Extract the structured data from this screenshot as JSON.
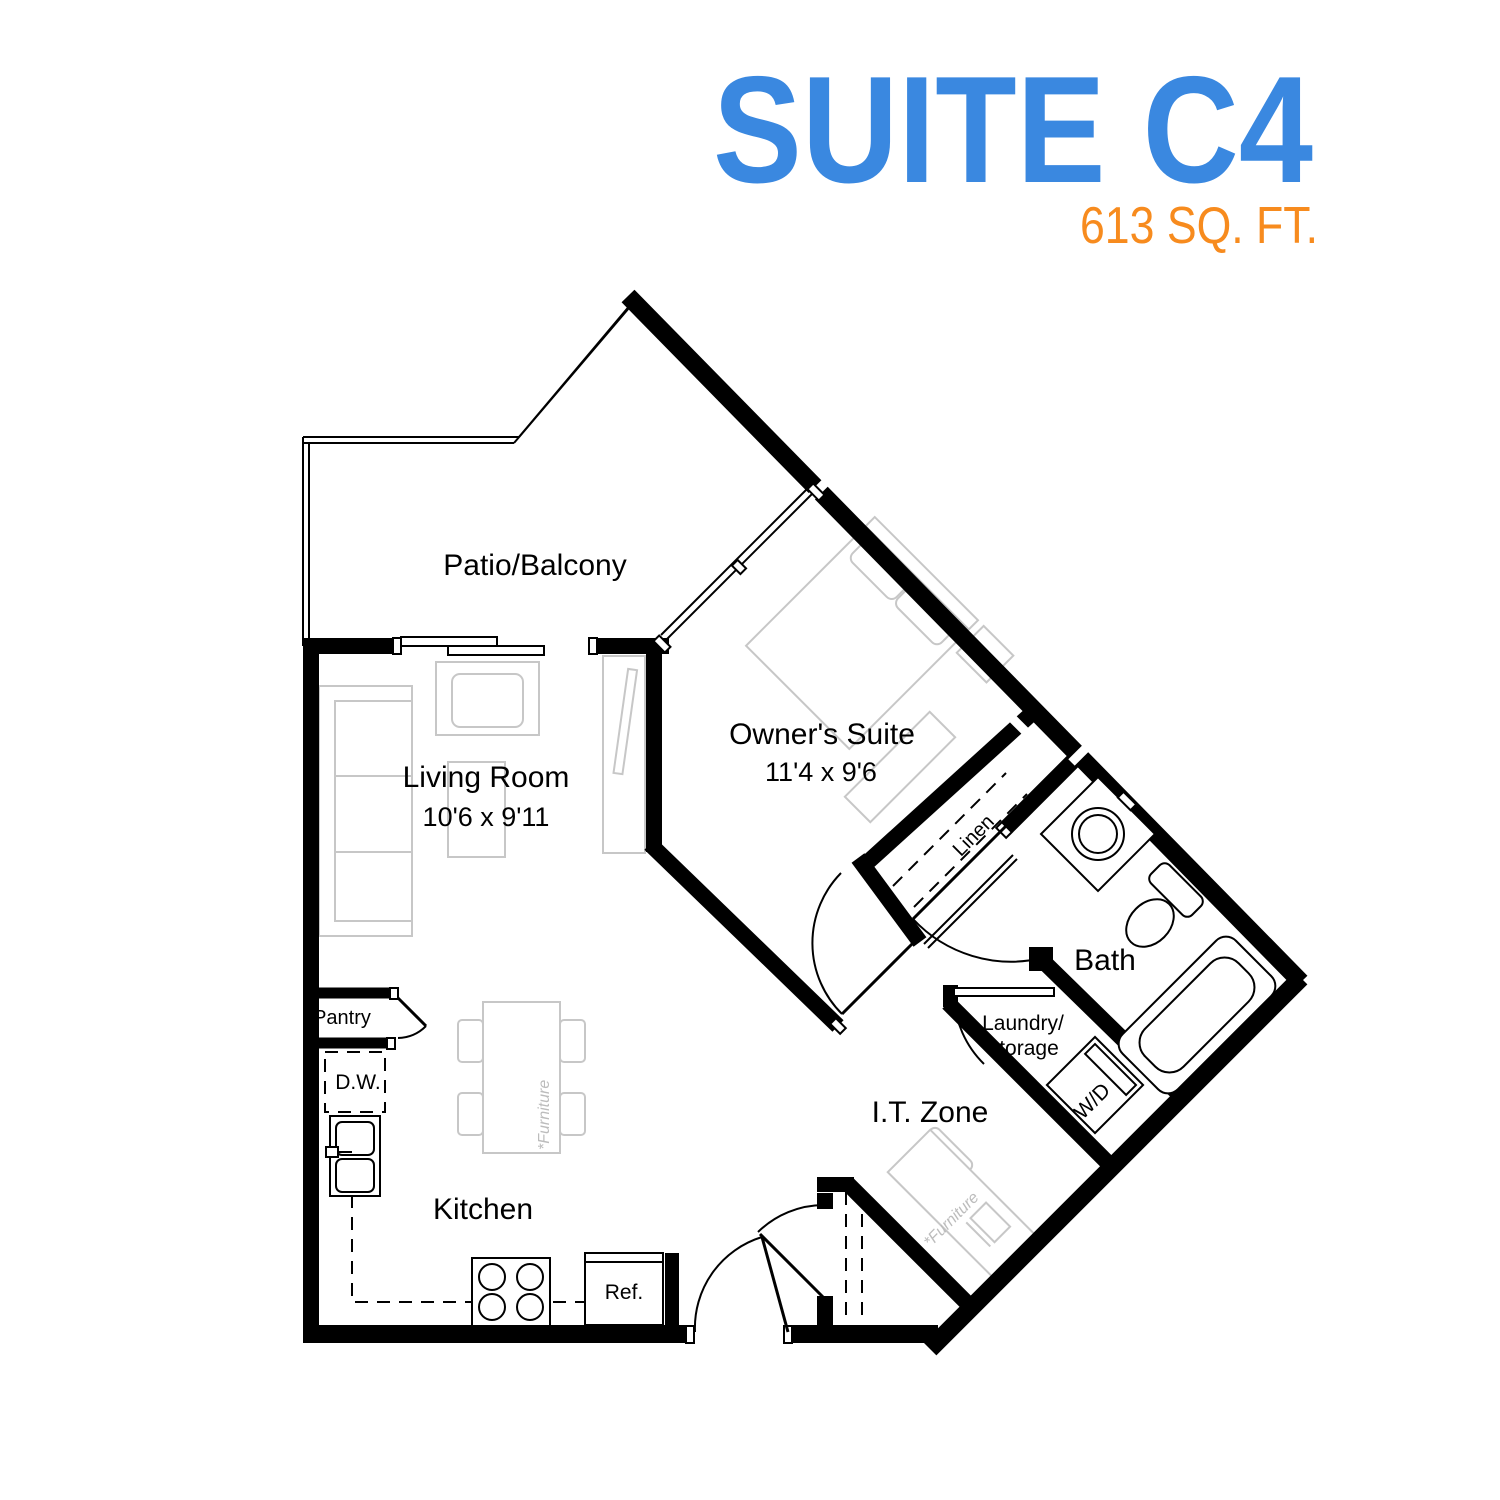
{
  "header": {
    "title": "SUITE C4",
    "subtitle": "613 SQ. FT.",
    "title_color": "#3a88e0",
    "subtitle_color": "#f78b1e"
  },
  "rooms": {
    "patio": {
      "label": "Patio/Balcony"
    },
    "living": {
      "label": "Living Room",
      "dims": "10'6 x 9'11"
    },
    "owners_suite": {
      "label": "Owner's Suite",
      "dims": "11'4 x 9'6"
    },
    "bath": {
      "label": "Bath"
    },
    "laundry": {
      "line1": "Laundry/",
      "line2": "Storage"
    },
    "it_zone": {
      "label": "I.T. Zone"
    },
    "kitchen": {
      "label": "Kitchen"
    },
    "pantry": {
      "label": "Pantry"
    }
  },
  "fixtures": {
    "dishwasher": "D.W.",
    "refrigerator": "Ref.",
    "washer_dryer": "W/D",
    "linen": "Linen",
    "furniture_note": "*Furniture"
  },
  "colors": {
    "walls": "#000000",
    "furniture_outline": "#c7c7c7",
    "furniture_text": "#bcbcbc",
    "background": "#ffffff"
  }
}
